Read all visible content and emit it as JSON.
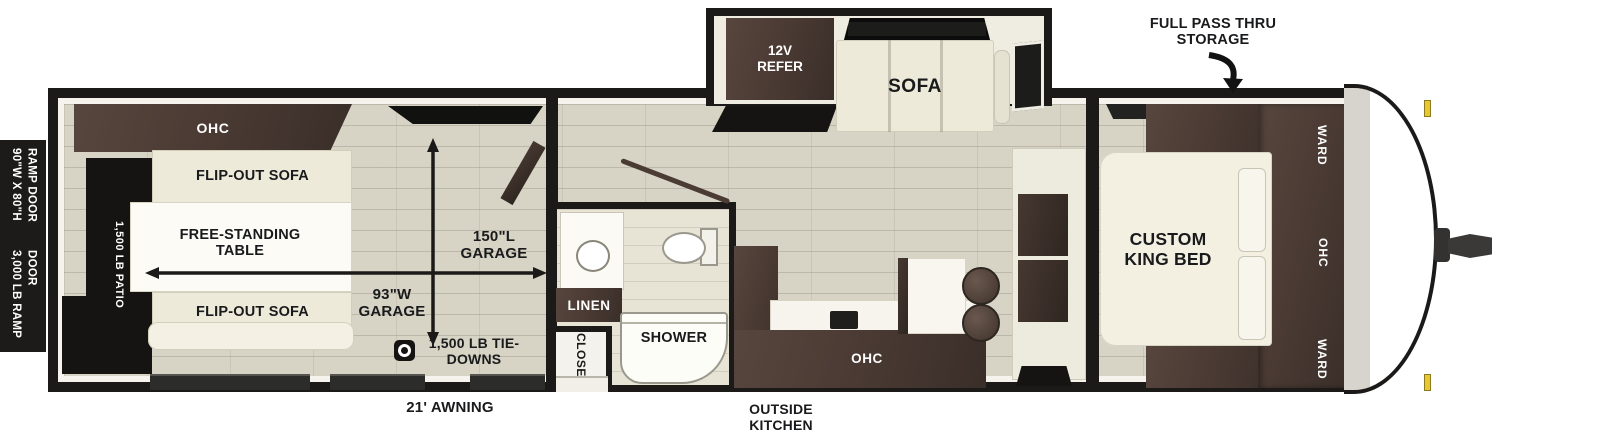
{
  "colors": {
    "wall": "#1c1a18",
    "floor": "#d8d4c5",
    "cabinet_wood": "#4a3a33",
    "furniture_cream": "#eeead9",
    "marker_yellow": "#e8c832",
    "text_dark": "#191a1c",
    "text_light": "#ffffff"
  },
  "callouts": {
    "full_pass_thru": "FULL PASS THRU STORAGE",
    "awning": "21' AWNING",
    "outside_kitchen": "OUTSIDE KITCHEN"
  },
  "ramp_door": {
    "size": "90\"W X 80\"H RAMP DOOR",
    "capacity": "3,000 LB RAMP DOOR"
  },
  "garage": {
    "ohc": "OHC",
    "flip_sofa_top": "FLIP-OUT SOFA",
    "flip_sofa_bottom": "FLIP-OUT SOFA",
    "table": "FREE-STANDING TABLE",
    "patio": "1,500 LB PATIO",
    "length": "150\"L GARAGE",
    "width": "93\"W GARAGE",
    "tie_downs": "1,500 LB TIE-DOWNS"
  },
  "bathroom": {
    "linen": "LINEN",
    "closet": "CLOSET",
    "shower": "SHOWER"
  },
  "living": {
    "refer": "12V REFER",
    "sofa": "SOFA",
    "kitchen_ohc": "OHC"
  },
  "bedroom": {
    "bed": "CUSTOM KING BED",
    "ward_top": "WARD",
    "ohc": "OHC",
    "ward_bottom": "WARD"
  }
}
